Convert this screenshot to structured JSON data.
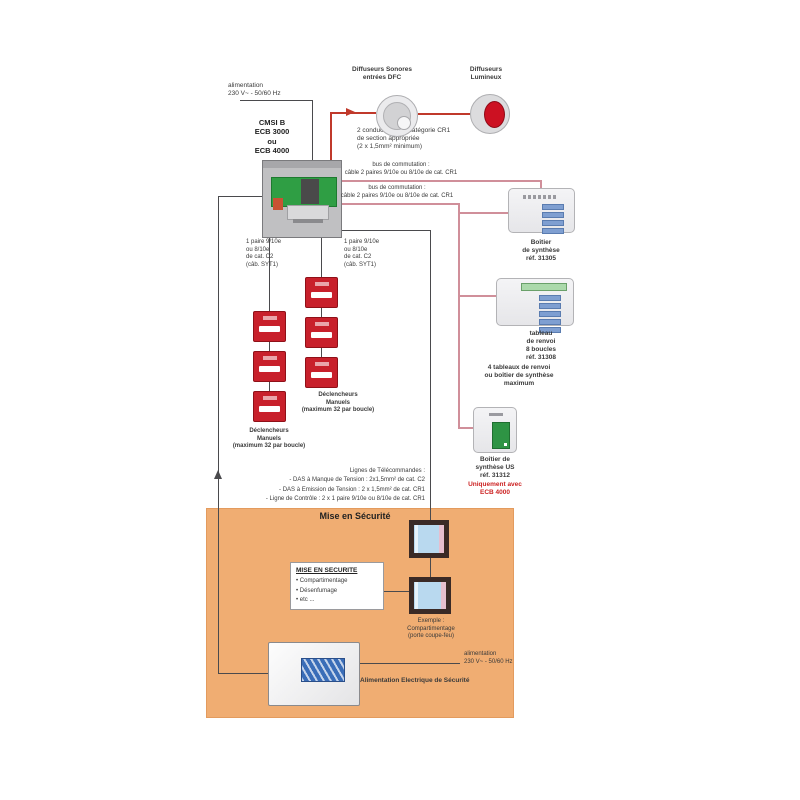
{
  "colors": {
    "zone_fill": "#f0ad72",
    "wire_black": "#4a4a4d",
    "alarm_red_line": "#c0392b",
    "bus_pink_line": "#d08f9a",
    "call_point_red": "#c8202b",
    "warning_text_red": "#cc2222",
    "board_green": "#2f9e44"
  },
  "top": {
    "mains": "alimentation\n230 V~ - 50/60 Hz",
    "cmsi": "CMSI B\nECB 3000\nou\nECB 4000",
    "sounders": "Diffuseurs Sonores\nentrées DFC",
    "beacons": "Diffuseurs\nLumineux",
    "sounder_wiring": "2 conducteurs de catégorie CR1\nde section appropriée\n(2 x 1,5mm² minimum)"
  },
  "bus": {
    "label1": "bus de commutation :\ncâble 2 paires 9/10e ou 8/10e de cat. CR1",
    "label2": "bus de commutation :\ncâble 2 paires 9/10e ou 8/10e de cat. CR1"
  },
  "loops": {
    "left_wiring": "1 paire 9/10e\nou 8/10e\nde cat. C2\n(câb. SYT1)",
    "right_wiring": "1 paire 9/10e\nou 8/10e\nde cat. C2\n(câb. SYT1)",
    "dm_left": "Déclencheurs\nManuels\n(maximum 32 par boucle)",
    "dm_right": "Déclencheurs\nManuels\n(maximum 32 par boucle)"
  },
  "telecommand": "Lignes de Télécommandes :\n- DAS à Manque de Tension : 2x1,5mm² de cat. C2\n- DAS à Emission de Tension : 2 x 1,5mm² de cat. CR1\n- Ligne de Contrôle : 2 x 1 paire 9/10e ou 8/10e de cat. CR1",
  "panels": {
    "synthese": "Boîtier\nde synthèse\nréf. 31305",
    "renvoi": "tableau\nde renvoi\n8 boucles\nréf. 31308",
    "renvoi_max": "4 tableaux de renvoi\nou boîtier de synthèse\nmaximum",
    "synthese_us": "Boîtier de\nsynthèse US\nréf. 31312",
    "synthese_us_note": "Uniquement avec\nECB 4000"
  },
  "zone": {
    "title": "Mise en Sécurité",
    "info_title": "MISE EN SECURITE",
    "info_items": "• Compartimentage\n• Désenfumage\n• etc ...",
    "door_caption": "Exemple :\nCompartimentage\n(porte coupe-feu)"
  },
  "psu": {
    "mains": "alimentation\n230 V~ - 50/60 Hz",
    "label": "Alimentation Electrique de Sécurité"
  }
}
